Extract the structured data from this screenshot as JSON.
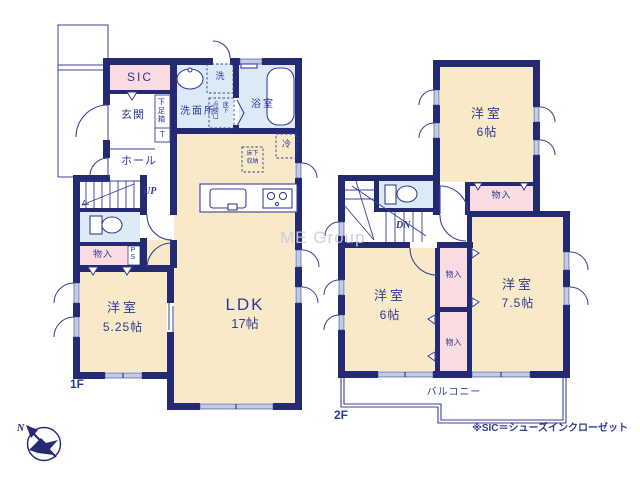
{
  "floor1": {
    "label": "1F",
    "sic": "SIC",
    "genkan": "玄関",
    "getabako": "下足箱",
    "getabako_t": "T",
    "hall": "ホール",
    "senmenjo": "洗面所",
    "washer": "洗",
    "hatch_col_right": "床下",
    "hatch_col_left": "点検口",
    "bath": "浴室",
    "fridge": "冷",
    "underfloor_top": "床下",
    "underfloor_bottom": "収納",
    "ldk_name": "LDK",
    "ldk_size": "17帖",
    "up": "UP",
    "monoire": "物入",
    "ps": "PS",
    "youshitsu_name": "洋室",
    "youshitsu_size": "5.25帖"
  },
  "floor2": {
    "label": "2F",
    "room_top_name": "洋室",
    "room_top_size": "6帖",
    "closet_top": "物入",
    "dn": "DN",
    "room_left_name": "洋室",
    "room_left_size": "6帖",
    "closet_mid_upper": "物入",
    "closet_mid_lower": "物入",
    "room_right_name": "洋室",
    "room_right_size": "7.5帖",
    "balcony": "バルコニー"
  },
  "annotations": {
    "watermark": "ME Group",
    "note": "※SIC＝シューズインクローゼット",
    "compass_north": "N"
  },
  "colors": {
    "wall": "#232a72",
    "line": "#3a4095",
    "cream": "#f8e9c8",
    "blue": "#dceaf6",
    "pink": "#f9dbe1",
    "window": "#c4cce0",
    "text": "#2e3b96",
    "watermark": "#caccdb"
  }
}
